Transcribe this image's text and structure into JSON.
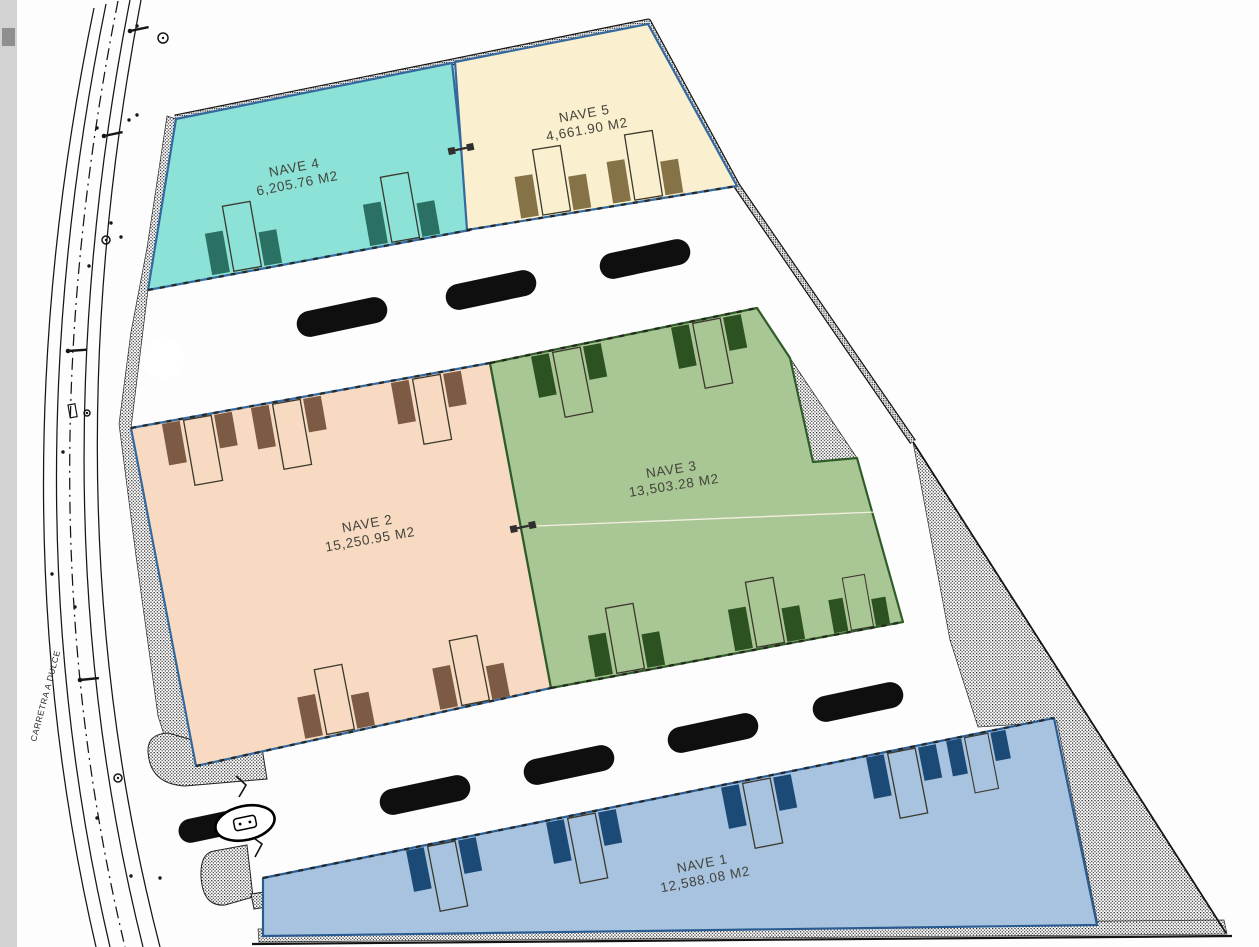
{
  "drawing": {
    "road_label": "CARRETRA A DULCE",
    "units_suffix": "M2",
    "colors": {
      "paper": "#fdfdfd",
      "ink": "#161616",
      "label_text": "#44443c",
      "scroll_track": "#d2d2d2",
      "scroll_thumb": "#8f8f8f",
      "split_line": "#f7f2e2"
    },
    "buildings": [
      {
        "id": "nave-4",
        "name": "NAVE 4",
        "area": "6,205.76 M2",
        "fill": "#8ce2d6",
        "stroke": "#34699f",
        "points": "176,119 452,63 470,230 148,290",
        "label": {
          "x": 295,
          "y": 172,
          "angle": -11
        }
      },
      {
        "id": "nave-5",
        "name": "NAVE 5",
        "area": "4,661.90 M2",
        "fill": "#faf0cf",
        "stroke": "#34699f",
        "points": "455,62 648,24 737,186 467,230",
        "label": {
          "x": 585,
          "y": 118,
          "angle": -10
        }
      },
      {
        "id": "nave-2",
        "name": "NAVE 2",
        "area": "15,250.95 M2",
        "fill": "#f7dac1",
        "stroke": "#34699f",
        "points": "131,428 490,363 551,688 196,766",
        "label": {
          "x": 368,
          "y": 528,
          "angle": -10
        }
      },
      {
        "id": "nave-3",
        "name": "NAVE 3",
        "area": "13,503.28 M2",
        "fill": "#a9c695",
        "stroke": "#2f5c28",
        "points": "490,363 757,308 790,358 813,462 857,458 903,622 551,688",
        "label": {
          "x": 672,
          "y": 474,
          "angle": -9
        }
      },
      {
        "id": "nave-1",
        "name": "NAVE 1",
        "area": "12,588.08 M2",
        "fill": "#a7c3df",
        "stroke": "#2b5c91",
        "points": "263,878 1054,718 1097,925 263,936",
        "label": {
          "x": 703,
          "y": 868,
          "angle": -11
        }
      }
    ],
    "wall_dashes": [
      [
        148,
        290,
        470,
        230
      ],
      [
        467,
        230,
        737,
        186
      ],
      [
        131,
        428,
        490,
        363
      ],
      [
        196,
        766,
        551,
        688
      ],
      [
        490,
        363,
        757,
        308
      ],
      [
        551,
        688,
        903,
        622
      ],
      [
        263,
        878,
        1054,
        718
      ]
    ],
    "hatches": [
      {
        "name": "west-sidewalk-band",
        "points": "176,119 148,290 131,428 196,766 179,781 158,716 136,556 119,424 131,332 147,248 167,116"
      },
      {
        "name": "wedge-east-of-nave-3",
        "points": "790,358 813,462 857,458"
      },
      {
        "name": "southeast-triangle",
        "points": "913,442 1226,933 1098,925 1057,722 978,727 950,640"
      },
      {
        "name": "south-strip",
        "points": "258,929 1224,920 1227,934 259,942"
      }
    ],
    "curbs": [
      {
        "name": "entrance-curb-north",
        "d": "M262,748 L267,779 L185,786 Q150,784 148,752 Q147,734 168,733 L196,741 Q232,747 262,748 Z"
      },
      {
        "name": "entrance-curb-south",
        "d": "M247,845 L253,897 L225,905 Q203,907 201,877 Q200,853 214,851 Z"
      },
      {
        "name": "entrance-curb-south-extension",
        "d": "M251,894 L333,882 L337,896 L254,909 Z"
      }
    ],
    "white_cutouts": [
      {
        "name": "turning-circle",
        "cx": 163,
        "cy": 358,
        "r": 21
      }
    ],
    "boundary_band": {
      "d": "M175,118 L452,62 L648,22 L737,186 L913,442"
    },
    "boundary_lines": [
      {
        "name": "east-boundary",
        "x1": 913,
        "y1": 442,
        "x2": 1226,
        "y2": 933,
        "w": 1.8
      },
      {
        "name": "south-boundary",
        "x1": 252,
        "y1": 944,
        "x2": 1232,
        "y2": 936,
        "w": 2.2
      }
    ],
    "road": {
      "curves": [
        {
          "d": "M94,8 Q-8,500 96,947"
        },
        {
          "d": "M106,4 Q5,500 110,947"
        },
        {
          "d": "M118,1 Q18,501 125,947",
          "dash": "12 5 2 5"
        },
        {
          "d": "M130,0 Q32,502 143,947"
        },
        {
          "d": "M141,0 Q45,503 160,947"
        }
      ],
      "dots": [
        [
          97,
          128
        ],
        [
          89,
          266
        ],
        [
          63,
          452
        ],
        [
          52,
          574
        ],
        [
          97,
          818
        ],
        [
          129,
          120
        ],
        [
          121,
          237
        ],
        [
          137,
          26
        ],
        [
          131,
          876
        ],
        [
          336,
          107
        ],
        [
          137,
          115
        ],
        [
          111,
          223
        ],
        [
          75,
          607
        ],
        [
          160,
          878
        ]
      ],
      "poles": [
        {
          "x": 130,
          "y": 31,
          "a": -12
        },
        {
          "x": 104,
          "y": 136,
          "a": -12
        },
        {
          "x": 68,
          "y": 351,
          "a": -4
        },
        {
          "x": 80,
          "y": 680,
          "a": -6
        }
      ],
      "circle_symbols": [
        {
          "x": 163,
          "y": 38,
          "r": 5
        },
        {
          "x": 106,
          "y": 240,
          "r": 4
        },
        {
          "x": 87,
          "y": 413,
          "r": 3
        },
        {
          "x": 118,
          "y": 778,
          "r": 4
        }
      ],
      "rect_symbols": [
        {
          "x": 68,
          "y": 405,
          "w": 7,
          "h": 13
        }
      ],
      "label_pos": {
        "x": 36,
        "y": 742,
        "angle": -75
      }
    },
    "docks": [
      {
        "x": 247,
        "y": 271,
        "a": -10,
        "dir": "up",
        "c": "#2a7164"
      },
      {
        "x": 405,
        "y": 242,
        "a": -10,
        "dir": "up",
        "c": "#2a7164"
      },
      {
        "x": 556,
        "y": 215,
        "a": -9,
        "dir": "up",
        "c": "#857347"
      },
      {
        "x": 648,
        "y": 200,
        "a": -9,
        "dir": "up",
        "c": "#857347"
      },
      {
        "x": 196,
        "y": 416,
        "a": -10,
        "dir": "down",
        "c": "#7d5a44"
      },
      {
        "x": 285,
        "y": 400,
        "a": -10,
        "dir": "down",
        "c": "#7d5a44"
      },
      {
        "x": 425,
        "y": 375,
        "a": -10,
        "dir": "down",
        "c": "#7d5a44"
      },
      {
        "x": 340,
        "y": 734,
        "a": -11,
        "dir": "up",
        "c": "#7d5a44"
      },
      {
        "x": 475,
        "y": 705,
        "a": -11,
        "dir": "up",
        "c": "#7d5a44"
      },
      {
        "x": 565,
        "y": 348,
        "a": -11,
        "dir": "down",
        "c": "#2d5222"
      },
      {
        "x": 705,
        "y": 319,
        "a": -11,
        "dir": "down",
        "c": "#2d5222"
      },
      {
        "x": 630,
        "y": 673,
        "a": -10,
        "dir": "up",
        "c": "#2d5222"
      },
      {
        "x": 770,
        "y": 647,
        "a": -10,
        "dir": "up",
        "c": "#2d5222"
      },
      {
        "x": 862,
        "y": 630,
        "a": -10,
        "dir": "up",
        "c": "#2d5222",
        "s": 0.8
      },
      {
        "x": 440,
        "y": 842,
        "a": -11,
        "dir": "down",
        "c": "#1c4a77"
      },
      {
        "x": 580,
        "y": 814,
        "a": -11,
        "dir": "down",
        "c": "#1c4a77"
      },
      {
        "x": 755,
        "y": 779,
        "a": -11,
        "dir": "down",
        "c": "#1c4a77"
      },
      {
        "x": 900,
        "y": 749,
        "a": -11,
        "dir": "down",
        "c": "#1c4a77"
      },
      {
        "x": 975,
        "y": 734,
        "a": -11,
        "dir": "down",
        "c": "#1c4a77",
        "s": 0.85
      }
    ],
    "cars": [
      {
        "x": 342,
        "y": 317,
        "a": -12
      },
      {
        "x": 491,
        "y": 290,
        "a": -12
      },
      {
        "x": 645,
        "y": 259,
        "a": -12
      },
      {
        "x": 425,
        "y": 795,
        "a": -12
      },
      {
        "x": 569,
        "y": 765,
        "a": -12
      },
      {
        "x": 713,
        "y": 733,
        "a": -12
      },
      {
        "x": 858,
        "y": 702,
        "a": -12
      },
      {
        "x": 213,
        "y": 826,
        "a": -12,
        "w": 70,
        "h": 24
      }
    ],
    "markers": [
      {
        "x": 461,
        "y": 149,
        "a": -12
      },
      {
        "x": 523,
        "y": 527,
        "a": -12
      }
    ],
    "split_line": {
      "x1": 537,
      "y1": 526,
      "x2": 876,
      "y2": 512
    },
    "gate": {
      "cx": 245,
      "cy": 823,
      "rx": 30,
      "ry": 17,
      "angle": -12,
      "squiggles": [
        "M236,776 l10,9 -7,12",
        "M251,836 l11,8 -7,13"
      ]
    }
  }
}
